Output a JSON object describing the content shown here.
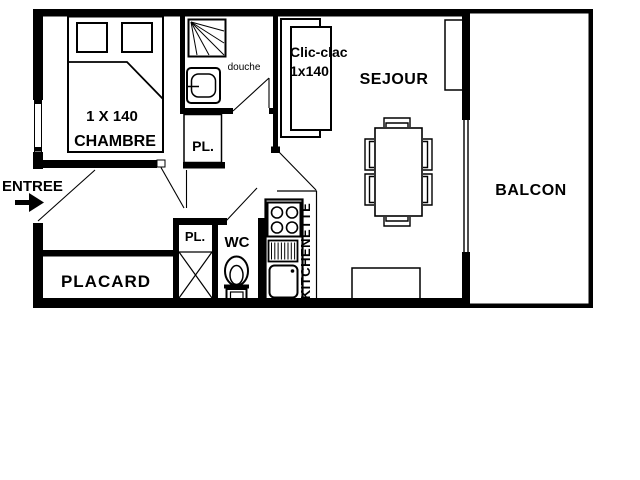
{
  "colors": {
    "wall": "#000000",
    "background": "#ffffff",
    "douche_text": "#3a3a3a"
  },
  "labels": {
    "entree": "ENTREE",
    "chambre": "CHAMBRE",
    "bed_size": "1 X 140",
    "douche": "douche",
    "pl_top": "PL.",
    "pl_bottom": "PL.",
    "wc": "WC",
    "kitchenette": "KITCHENETTE",
    "placard": "PLACARD",
    "sofa_line1": "Clic-clac",
    "sofa_line2": "1x140",
    "sejour": "SEJOUR",
    "balcon": "BALCON"
  }
}
